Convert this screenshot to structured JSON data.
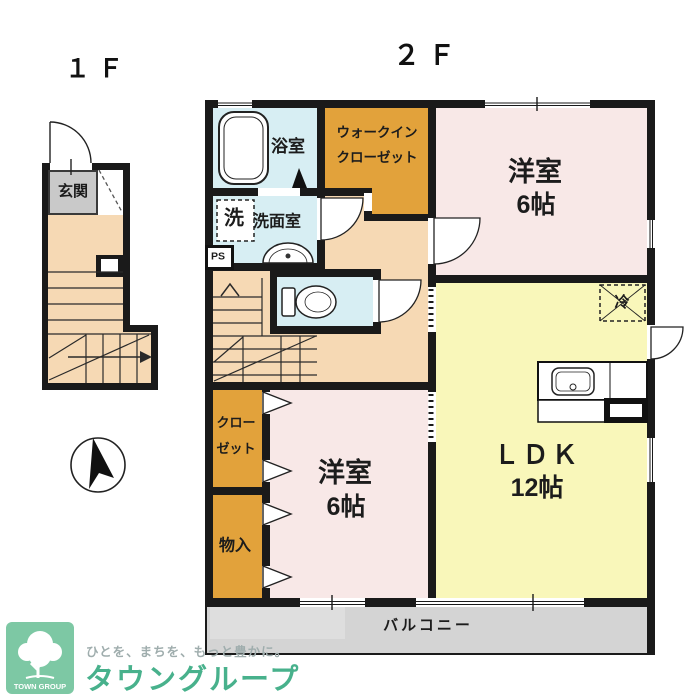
{
  "floors": {
    "f1": {
      "label": "１Ｆ",
      "rooms": {
        "genkan": "玄関"
      }
    },
    "f2": {
      "label": "２Ｆ",
      "rooms": {
        "bathroom": "浴室",
        "walkin_closet_line1": "ウォークイン",
        "walkin_closet_line2": "クローゼット",
        "washing_machine": "洗",
        "washroom": "洗面室",
        "pipe_space": "PS",
        "bedroom_top_name": "洋室",
        "bedroom_top_size": "6帖",
        "refrigerator": "冷",
        "ldk_name": "ＬＤＫ",
        "ldk_size": "12帖",
        "closet_line1": "クロー",
        "closet_line2": "ゼット",
        "storage": "物入",
        "bedroom_bottom_name": "洋室",
        "bedroom_bottom_size": "6帖",
        "balcony": "バルコニー"
      }
    }
  },
  "branding": {
    "logo_text": "TOWN GROUP",
    "tagline": "ひとを、まちを、もっと豊かに。",
    "company_name": "タウングループ"
  },
  "colors": {
    "wall": "#1a1a1a",
    "bedroom_pink": "#f8e8e7",
    "ldk_yellow": "#f9f7ba",
    "closet_orange": "#e2a23b",
    "wet_area_blue": "#d7eef3",
    "hallway_peach": "#f6d9b4",
    "genkan_gray": "#c9c9c9",
    "balcony_gray": "#d4d4d4",
    "brand_green": "#48b18c",
    "logo_bg_green": "#7dc8a4"
  }
}
